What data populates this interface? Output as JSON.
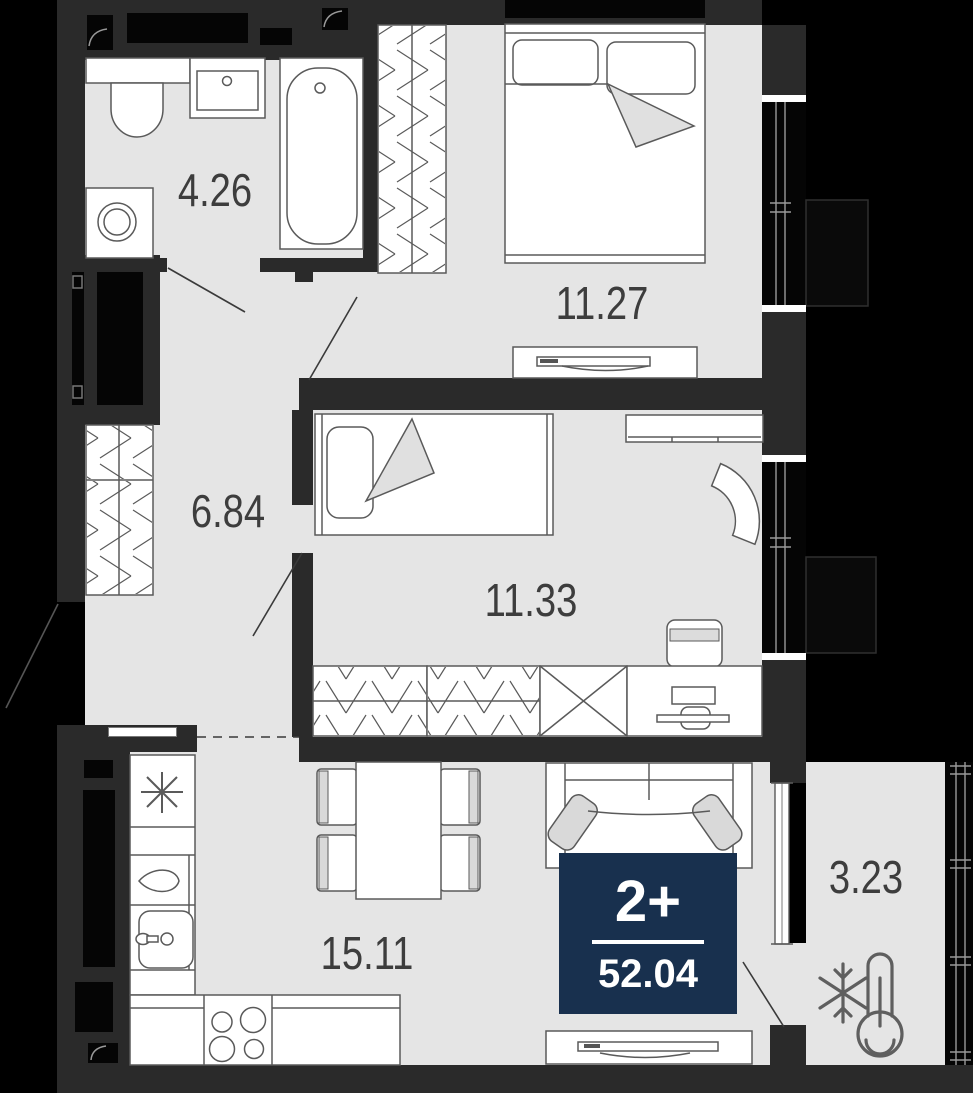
{
  "title": "Apartment floor plan",
  "badge": {
    "rooms": "2+",
    "area": "52.04"
  },
  "rooms": [
    {
      "id": "bathroom",
      "area": "4.26"
    },
    {
      "id": "hallway",
      "area": "6.84"
    },
    {
      "id": "bedroom-1",
      "area": "11.27"
    },
    {
      "id": "bedroom-2",
      "area": "11.33"
    },
    {
      "id": "kitchen-living",
      "area": "15.11"
    },
    {
      "id": "balcony",
      "area": "3.23"
    }
  ],
  "colors": {
    "outside": "#000000",
    "wall": "#2a2a2a",
    "floor": "#e5e5e5",
    "furniture_stroke": "#5a5a5a",
    "label_text": "#3d3d3d",
    "badge_bg": "#18304e",
    "badge_text": "#ffffff",
    "soft_fill": "#dcdcdc"
  },
  "icons": [
    "snowflake-thermometer-icon",
    "fridge-asterisk-icon",
    "water-drop-icon",
    "vent-duct-icon"
  ]
}
